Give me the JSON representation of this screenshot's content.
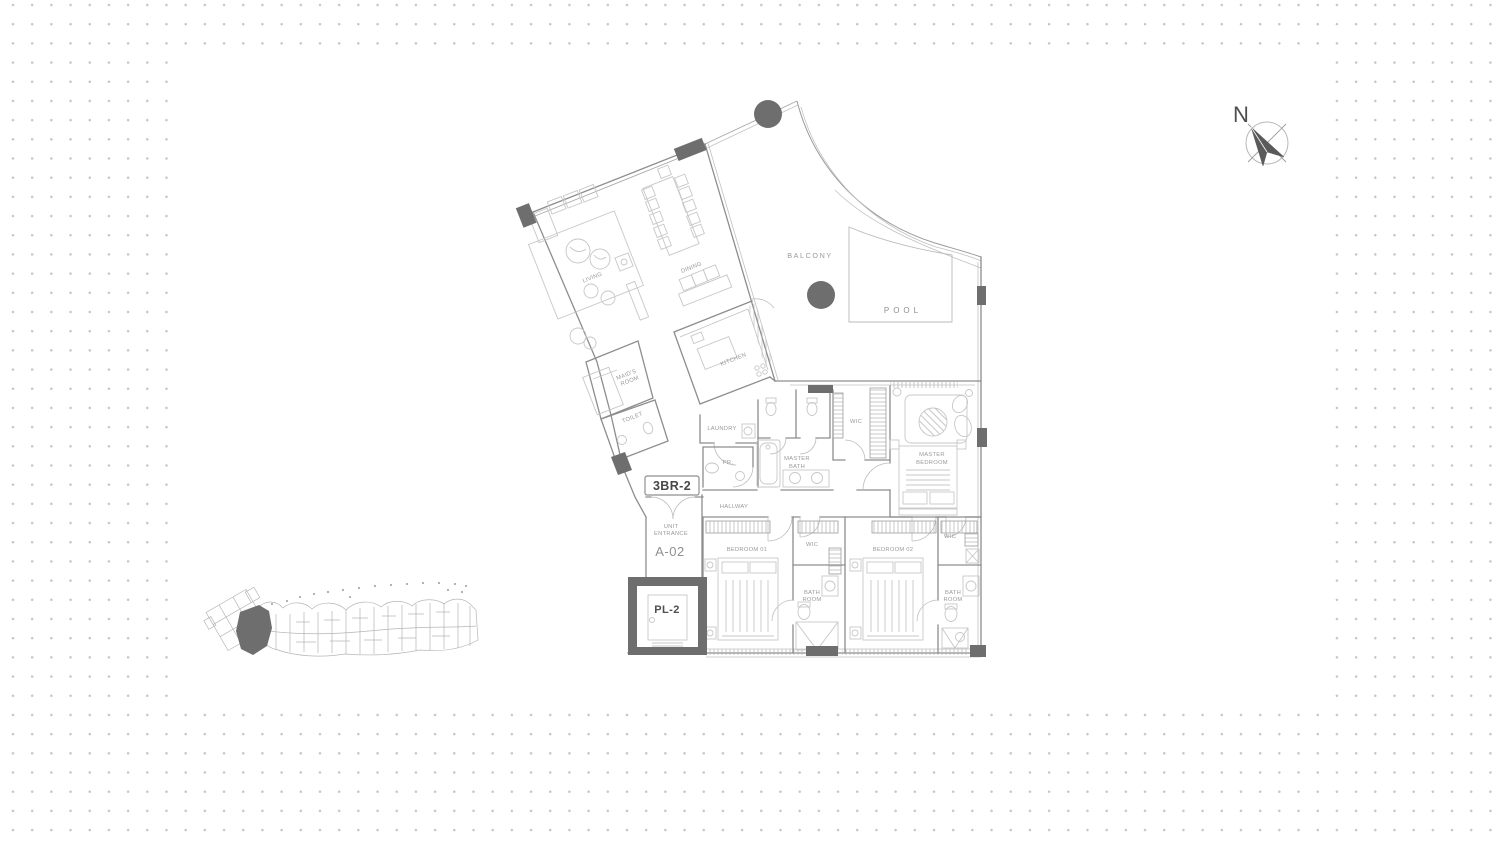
{
  "page": {
    "dot_color": "#c6c6c6",
    "canvas_color": "#ffffff"
  },
  "compass": {
    "north_label": "N"
  },
  "floor_plan": {
    "unit_type_badge": "3BR-2",
    "unit_number": "A-02",
    "elevator_label": "PL-2",
    "rooms": {
      "living": "LIVING",
      "dining": "DINING",
      "kitchen": "KITCHEN",
      "maids_room_line1": "MAID'S",
      "maids_room_line2": "ROOM",
      "toilet": "TOILET",
      "laundry": "LAUNDRY",
      "powder_room": "PR.",
      "master_bath_line1": "MASTER",
      "master_bath_line2": "BATH",
      "wic_master": "WIC",
      "master_bedroom_line1": "MASTER",
      "master_bedroom_line2": "BEDROOM",
      "hallway": "HALLWAY",
      "unit_entrance_line1": "UNIT",
      "unit_entrance_line2": "ENTRANCE",
      "bedroom_01": "BEDROOM 01",
      "wic_1": "WIC",
      "bathroom_1_line1": "BATH",
      "bathroom_1_line2": "ROOM",
      "bedroom_02": "BEDROOM 02",
      "wic_2": "WIC",
      "bathroom_2_line1": "BATH",
      "bathroom_2_line2": "ROOM",
      "balcony": "BALCONY",
      "pool": "POOL"
    },
    "colors": {
      "wall": "#8d8d8d",
      "furniture": "#c7c7c7",
      "dark_fill": "#6e6e6e",
      "label": "#9a9a9a"
    }
  },
  "key_plan": {
    "highlight_color": "#6e6e6e",
    "line_color": "#b6b6b6"
  }
}
